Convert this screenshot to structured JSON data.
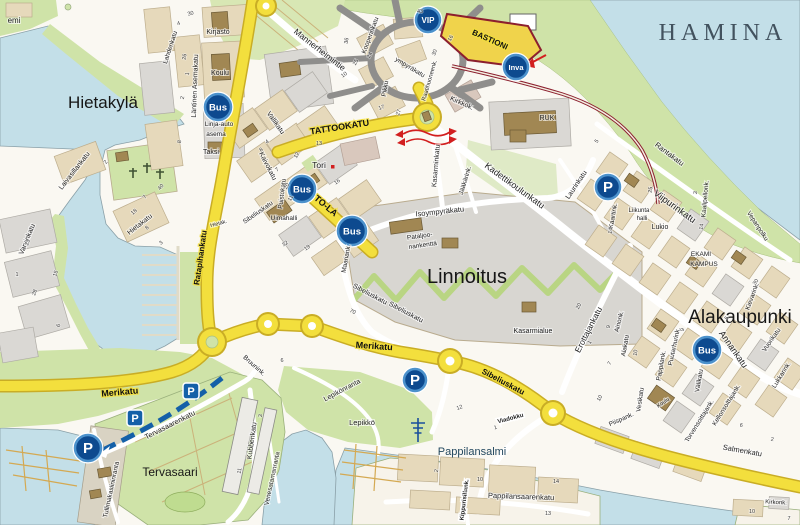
{
  "map_title": "HAMINA",
  "colors": {
    "water": "#c3dfe8",
    "green": "#cfe3a8",
    "yellow_road": "#f3df3d",
    "yellow_edge": "#c9ad25",
    "block_beige": "#e6d9bb",
    "block_gray": "#dad8d4",
    "building_brown": "#a18753",
    "markerBlue": "#0d4a8f",
    "markerRing": "#4c92cc",
    "parkingBlue": "#1460a8",
    "red": "#d21f1f",
    "dark_red": "#8c1f2e"
  },
  "icons": [
    {
      "type": "bus",
      "label": "Bus",
      "x": 218,
      "y": 107,
      "r": 13
    },
    {
      "type": "bus",
      "label": "Bus",
      "x": 302,
      "y": 189,
      "r": 13
    },
    {
      "type": "bus",
      "label": "Bus",
      "x": 352,
      "y": 231,
      "r": 14
    },
    {
      "type": "bus",
      "label": "Bus",
      "x": 707,
      "y": 350,
      "r": 13
    },
    {
      "type": "vip",
      "label": "VIP",
      "x": 428,
      "y": 20,
      "r": 12
    },
    {
      "type": "inva",
      "label": "Inva",
      "x": 516,
      "y": 67,
      "r": 12
    },
    {
      "type": "p-circle",
      "label": "P",
      "x": 608,
      "y": 187,
      "r": 12
    },
    {
      "type": "p-circle",
      "label": "P",
      "x": 415,
      "y": 380,
      "r": 11
    },
    {
      "type": "p-circle",
      "label": "P",
      "x": 88,
      "y": 448,
      "r": 13
    },
    {
      "type": "p-square",
      "label": "P",
      "x": 191,
      "y": 391
    },
    {
      "type": "p-square",
      "label": "P",
      "x": 135,
      "y": 418
    }
  ],
  "labels": [
    {
      "t": "HAMINA",
      "x": 723,
      "y": 40,
      "r": 0,
      "s": 24,
      "k": "title"
    },
    {
      "t": "Hietakylä",
      "x": 103,
      "y": 108,
      "r": 0,
      "s": 17,
      "k": "district"
    },
    {
      "t": "Linnoitus",
      "x": 467,
      "y": 283,
      "r": 0,
      "s": 20,
      "k": "district"
    },
    {
      "t": "Alakaupunki",
      "x": 740,
      "y": 323,
      "r": 0,
      "s": 19,
      "k": "district"
    },
    {
      "t": "Tervasaari",
      "x": 170,
      "y": 476,
      "r": 0,
      "s": 12,
      "k": "district"
    },
    {
      "t": "Pappilansalmi",
      "x": 472,
      "y": 455,
      "r": 0,
      "s": 11,
      "k": "water"
    },
    {
      "t": "emi",
      "x": 14,
      "y": 23,
      "r": 0,
      "s": 8,
      "k": "place"
    },
    {
      "t": "TATTOOKATU",
      "x": 340,
      "y": 130,
      "r": -9,
      "s": 9,
      "k": "ystreet"
    },
    {
      "t": "TO-LA",
      "x": 324,
      "y": 208,
      "r": 40,
      "s": 9,
      "k": "ystreet"
    },
    {
      "t": "BASTIONI",
      "x": 489,
      "y": 42,
      "r": 24,
      "s": 8,
      "k": "ystreet"
    },
    {
      "t": "Merikatu",
      "x": 120,
      "y": 395,
      "r": -5,
      "s": 9,
      "k": "ystreet"
    },
    {
      "t": "Merikatu",
      "x": 374,
      "y": 349,
      "r": 4,
      "s": 9,
      "k": "ystreet"
    },
    {
      "t": "Sibeliuskatu",
      "x": 502,
      "y": 384,
      "r": 28,
      "s": 8,
      "k": "ystreet"
    },
    {
      "t": "Ratapihankatu",
      "x": 203,
      "y": 258,
      "r": -82,
      "s": 8,
      "k": "ystreet"
    },
    {
      "t": "Mannerheimintie",
      "x": 318,
      "y": 52,
      "r": 38,
      "s": 8.5,
      "k": "street"
    },
    {
      "t": "Kadettikoulunkatu",
      "x": 513,
      "y": 188,
      "r": 36,
      "s": 9,
      "k": "street"
    },
    {
      "t": "Viipurinkatu",
      "x": 673,
      "y": 209,
      "r": 36,
      "s": 9.5,
      "k": "street"
    },
    {
      "t": "Rantakatu",
      "x": 668,
      "y": 156,
      "r": 37,
      "s": 7.5,
      "k": "street"
    },
    {
      "t": "Laurinkatu",
      "x": 578,
      "y": 186,
      "r": -56,
      "s": 7,
      "k": "street"
    },
    {
      "t": "Kirkkok.",
      "x": 461,
      "y": 105,
      "r": 24,
      "s": 7,
      "k": "street"
    },
    {
      "t": "Kasarminkatu",
      "x": 438,
      "y": 166,
      "r": -85,
      "s": 7,
      "k": "street"
    },
    {
      "t": "Jääkärink.",
      "x": 467,
      "y": 181,
      "r": -73,
      "s": 6.5,
      "k": "street"
    },
    {
      "t": "Isoympyräkatu",
      "x": 440,
      "y": 214,
      "r": -6,
      "s": 7.5,
      "k": "street"
    },
    {
      "t": "Kaivokatu",
      "x": 266,
      "y": 167,
      "r": 63,
      "s": 7,
      "k": "street"
    },
    {
      "t": "Vallikatu",
      "x": 274,
      "y": 124,
      "r": 55,
      "s": 7,
      "k": "street"
    },
    {
      "t": "Puistokatu",
      "x": 284,
      "y": 194,
      "r": -83,
      "s": 6.5,
      "k": "street"
    },
    {
      "t": "Läntinen Asemakatu",
      "x": 197,
      "y": 86,
      "r": -88,
      "s": 7,
      "k": "street"
    },
    {
      "t": "Lahdenkatu",
      "x": 172,
      "y": 48,
      "r": -72,
      "s": 6.5,
      "k": "street"
    },
    {
      "t": "Laivasillankatu",
      "x": 76,
      "y": 172,
      "r": -52,
      "s": 7,
      "k": "street"
    },
    {
      "t": "Hietakatu",
      "x": 141,
      "y": 226,
      "r": -38,
      "s": 7,
      "k": "street"
    },
    {
      "t": "Hietak.",
      "x": 219,
      "y": 225,
      "r": -15,
      "s": 5.5,
      "k": "street"
    },
    {
      "t": "Varvinkatu",
      "x": 29,
      "y": 240,
      "r": -68,
      "s": 7,
      "k": "street"
    },
    {
      "t": "Sibeliuskatu",
      "x": 259,
      "y": 214,
      "r": -35,
      "s": 6.5,
      "k": "street"
    },
    {
      "t": "Sibeliuskatu",
      "x": 369,
      "y": 296,
      "r": 28,
      "s": 7,
      "k": "street"
    },
    {
      "t": "Sibeliuskatu",
      "x": 405,
      "y": 314,
      "r": 28,
      "s": 7,
      "k": "street"
    },
    {
      "t": "Maariank.",
      "x": 348,
      "y": 259,
      "r": -80,
      "s": 6.5,
      "k": "street"
    },
    {
      "t": "Erottajankatu",
      "x": 591,
      "y": 331,
      "r": -63,
      "s": 8.5,
      "k": "street"
    },
    {
      "t": "Ainonk.",
      "x": 621,
      "y": 322,
      "r": -76,
      "s": 6.5,
      "k": "street"
    },
    {
      "t": "Alakatu",
      "x": 627,
      "y": 346,
      "r": -80,
      "s": 6.5,
      "k": "street"
    },
    {
      "t": "Annankatu",
      "x": 731,
      "y": 351,
      "r": 55,
      "s": 9,
      "k": "street"
    },
    {
      "t": "Puutarhurink.",
      "x": 676,
      "y": 347,
      "r": -78,
      "s": 6.5,
      "k": "street"
    },
    {
      "t": "Pappilank.",
      "x": 663,
      "y": 366,
      "r": -80,
      "s": 6.5,
      "k": "street"
    },
    {
      "t": "Vesikatu",
      "x": 642,
      "y": 400,
      "r": -82,
      "s": 6.5,
      "k": "street"
    },
    {
      "t": "Piispank.",
      "x": 622,
      "y": 421,
      "r": -24,
      "s": 6.5,
      "k": "street"
    },
    {
      "t": "Välikatu",
      "x": 701,
      "y": 381,
      "r": -80,
      "s": 6.5,
      "k": "street"
    },
    {
      "t": "Torvensoittajank.",
      "x": 701,
      "y": 422,
      "r": -58,
      "s": 6.5,
      "k": "street"
    },
    {
      "t": "Kellonsoittajank.",
      "x": 728,
      "y": 406,
      "r": -58,
      "s": 6.5,
      "k": "street"
    },
    {
      "t": "Salmenkatu",
      "x": 742,
      "y": 453,
      "r": 10,
      "s": 7.5,
      "k": "street"
    },
    {
      "t": "Vuorikatu",
      "x": 773,
      "y": 341,
      "r": -55,
      "s": 6.5,
      "k": "street"
    },
    {
      "t": "Lukkarink.",
      "x": 783,
      "y": 376,
      "r": -58,
      "s": 6.5,
      "k": "street"
    },
    {
      "t": "Kievarink.",
      "x": 754,
      "y": 297,
      "r": -70,
      "s": 6.5,
      "k": "street"
    },
    {
      "t": "Kaartink.",
      "x": 615,
      "y": 216,
      "r": -80,
      "s": 6.5,
      "k": "street"
    },
    {
      "t": "Kaalipellonk.",
      "x": 707,
      "y": 199,
      "r": -85,
      "s": 6.5,
      "k": "street"
    },
    {
      "t": "Vepanpolku",
      "x": 756,
      "y": 227,
      "r": 57,
      "s": 6.5,
      "k": "street"
    },
    {
      "t": "Kirkonk.",
      "x": 776,
      "y": 504,
      "r": 3,
      "s": 6,
      "k": "street"
    },
    {
      "t": "Tervasaarenkatu",
      "x": 171,
      "y": 427,
      "r": -27,
      "s": 7.5,
      "k": "street"
    },
    {
      "t": "Tullimakasiininranta",
      "x": 113,
      "y": 490,
      "r": -78,
      "s": 6.5,
      "k": "street"
    },
    {
      "t": "Kubbenkatu",
      "x": 254,
      "y": 441,
      "r": -82,
      "s": 7,
      "k": "street"
    },
    {
      "t": "Venesatamanranta",
      "x": 274,
      "y": 479,
      "r": -78,
      "s": 6.5,
      "k": "street"
    },
    {
      "t": "Lepikönranta",
      "x": 343,
      "y": 392,
      "r": -28,
      "s": 7,
      "k": "street"
    },
    {
      "t": "Bruunink.",
      "x": 253,
      "y": 367,
      "r": 42,
      "s": 6.5,
      "k": "street"
    },
    {
      "t": "Pappilansaarenkatu",
      "x": 521,
      "y": 499,
      "r": 2,
      "s": 7.5,
      "k": "street"
    },
    {
      "t": "Kippurisillank.",
      "x": 466,
      "y": 500,
      "r": -83,
      "s": 6,
      "k": "box"
    },
    {
      "t": "Viadokku",
      "x": 511,
      "y": 420,
      "r": -15,
      "s": 6,
      "k": "box"
    },
    {
      "t": "Pikku",
      "x": 387,
      "y": 89,
      "r": -80,
      "s": 6.5,
      "k": "street"
    },
    {
      "t": "ympyräkatu",
      "x": 409,
      "y": 69,
      "r": 31,
      "s": 6.5,
      "k": "street"
    },
    {
      "t": "Kooperinkatu",
      "x": 372,
      "y": 36,
      "r": -70,
      "s": 6.5,
      "k": "street"
    },
    {
      "t": "Raatihuoneenk.",
      "x": 431,
      "y": 81,
      "r": -74,
      "s": 6,
      "k": "street"
    },
    {
      "t": "Kirjasto",
      "x": 218,
      "y": 34,
      "r": 0,
      "s": 7,
      "k": "place"
    },
    {
      "t": "Koulu",
      "x": 220,
      "y": 75,
      "r": 0,
      "s": 7,
      "k": "place"
    },
    {
      "t": "Linja-auto",
      "x": 219,
      "y": 126,
      "r": 0,
      "s": 6.5,
      "k": "place"
    },
    {
      "t": "asema",
      "x": 216,
      "y": 136,
      "r": 0,
      "s": 6.5,
      "k": "place"
    },
    {
      "t": "Taksi",
      "x": 211,
      "y": 154,
      "r": 0,
      "s": 7,
      "k": "place"
    },
    {
      "t": "Tori",
      "x": 319,
      "y": 168,
      "r": 0,
      "s": 8.5,
      "k": "place"
    },
    {
      "t": "Uimahalli",
      "x": 284,
      "y": 220,
      "r": 0,
      "s": 6.5,
      "k": "place"
    },
    {
      "t": "RUK",
      "x": 547,
      "y": 120,
      "r": 0,
      "s": 7,
      "k": "place"
    },
    {
      "t": "Kasarmialue",
      "x": 533,
      "y": 333,
      "r": 0,
      "s": 7,
      "k": "place"
    },
    {
      "t": "Pataljoo-",
      "x": 420,
      "y": 238,
      "r": -8,
      "s": 6.5,
      "k": "place"
    },
    {
      "t": "nankenttä",
      "x": 423,
      "y": 247,
      "r": -8,
      "s": 6.5,
      "k": "place"
    },
    {
      "t": "Lukio",
      "x": 660,
      "y": 229,
      "r": 0,
      "s": 7,
      "k": "place"
    },
    {
      "t": "Liikunta",
      "x": 639,
      "y": 212,
      "r": 0,
      "s": 6,
      "k": "place"
    },
    {
      "t": "halli",
      "x": 642,
      "y": 220,
      "r": 0,
      "s": 6,
      "k": "place"
    },
    {
      "t": "EKAMI",
      "x": 701,
      "y": 256,
      "r": 0,
      "s": 6.5,
      "k": "place"
    },
    {
      "t": "KAMPUS",
      "x": 704,
      "y": 266,
      "r": 0,
      "s": 6.5,
      "k": "place"
    },
    {
      "t": "Koulu",
      "x": 664,
      "y": 404,
      "r": -35,
      "s": 5.5,
      "k": "place"
    },
    {
      "t": "Lepikkö",
      "x": 362,
      "y": 425,
      "r": 0,
      "s": 7.5,
      "k": "place"
    },
    {
      "t": "30",
      "x": 191,
      "y": 15,
      "r": -15,
      "s": 5.5,
      "k": "num"
    },
    {
      "t": "4",
      "x": 179,
      "y": 25,
      "r": -15,
      "s": 5.5,
      "k": "num"
    },
    {
      "t": "26",
      "x": 186,
      "y": 57,
      "r": -80,
      "s": 5.5,
      "k": "num"
    },
    {
      "t": "1",
      "x": 189,
      "y": 74,
      "r": -80,
      "s": 5.5,
      "k": "num"
    },
    {
      "t": "2",
      "x": 184,
      "y": 98,
      "r": -80,
      "s": 5.5,
      "k": "num"
    },
    {
      "t": "8",
      "x": 181,
      "y": 142,
      "r": -80,
      "s": 5.5,
      "k": "num"
    },
    {
      "t": "23",
      "x": 29,
      "y": 243,
      "r": -70,
      "s": 5.5,
      "k": "num"
    },
    {
      "t": "15",
      "x": 57,
      "y": 274,
      "r": -70,
      "s": 5.5,
      "k": "num"
    },
    {
      "t": "28",
      "x": 36,
      "y": 293,
      "r": -70,
      "s": 5.5,
      "k": "num"
    },
    {
      "t": "6",
      "x": 60,
      "y": 326,
      "r": -70,
      "s": 5.5,
      "k": "num"
    },
    {
      "t": "1",
      "x": 17,
      "y": 276,
      "r": 0,
      "s": 5.5,
      "k": "num"
    },
    {
      "t": "40",
      "x": 162,
      "y": 188,
      "r": -50,
      "s": 5.5,
      "k": "num"
    },
    {
      "t": "7",
      "x": 146,
      "y": 198,
      "r": -50,
      "s": 5.5,
      "k": "num"
    },
    {
      "t": "18",
      "x": 135,
      "y": 213,
      "r": -40,
      "s": 5.5,
      "k": "num"
    },
    {
      "t": "8",
      "x": 148,
      "y": 229,
      "r": -40,
      "s": 5.5,
      "k": "num"
    },
    {
      "t": "3",
      "x": 162,
      "y": 244,
      "r": -40,
      "s": 5.5,
      "k": "num"
    },
    {
      "t": "2",
      "x": 107,
      "y": 163,
      "r": -55,
      "s": 5.5,
      "k": "num"
    },
    {
      "t": "4",
      "x": 268,
      "y": 143,
      "r": -35,
      "s": 5.5,
      "k": "num"
    },
    {
      "t": "8",
      "x": 262,
      "y": 151,
      "r": -35,
      "s": 5.5,
      "k": "num"
    },
    {
      "t": "7",
      "x": 278,
      "y": 171,
      "r": -35,
      "s": 5.5,
      "k": "num"
    },
    {
      "t": "12",
      "x": 298,
      "y": 156,
      "r": -60,
      "s": 5.5,
      "k": "num"
    },
    {
      "t": "13",
      "x": 319,
      "y": 145,
      "r": 0,
      "s": 5.5,
      "k": "num"
    },
    {
      "t": "16",
      "x": 338,
      "y": 183,
      "r": -35,
      "s": 5.5,
      "k": "num"
    },
    {
      "t": "20",
      "x": 288,
      "y": 187,
      "r": -60,
      "s": 5.5,
      "k": "num"
    },
    {
      "t": "11",
      "x": 292,
      "y": 199,
      "r": -60,
      "s": 5.5,
      "k": "num"
    },
    {
      "t": "19",
      "x": 308,
      "y": 249,
      "r": -35,
      "s": 5.5,
      "k": "num"
    },
    {
      "t": "32",
      "x": 286,
      "y": 245,
      "r": -35,
      "s": 5.5,
      "k": "num"
    },
    {
      "t": "24",
      "x": 371,
      "y": 56,
      "r": -60,
      "s": 5.5,
      "k": "num"
    },
    {
      "t": "25",
      "x": 357,
      "y": 63,
      "r": -60,
      "s": 5.5,
      "k": "num"
    },
    {
      "t": "36",
      "x": 348,
      "y": 41,
      "r": -80,
      "s": 5.5,
      "k": "num"
    },
    {
      "t": "17",
      "x": 382,
      "y": 109,
      "r": -20,
      "s": 5.5,
      "k": "num"
    },
    {
      "t": "27",
      "x": 400,
      "y": 113,
      "r": -70,
      "s": 5.5,
      "k": "num"
    },
    {
      "t": "30",
      "x": 436,
      "y": 53,
      "r": -70,
      "s": 5.5,
      "k": "num"
    },
    {
      "t": "16",
      "x": 452,
      "y": 39,
      "r": -60,
      "s": 5.5,
      "k": "num"
    },
    {
      "t": "43",
      "x": 420,
      "y": 13,
      "r": 0,
      "s": 5.5,
      "k": "num"
    },
    {
      "t": "10",
      "x": 345,
      "y": 76,
      "r": -35,
      "s": 5.5,
      "k": "num"
    },
    {
      "t": "5",
      "x": 598,
      "y": 142,
      "r": -55,
      "s": 5.5,
      "k": "num"
    },
    {
      "t": "25",
      "x": 652,
      "y": 190,
      "r": -80,
      "s": 5.5,
      "k": "num"
    },
    {
      "t": "3",
      "x": 697,
      "y": 193,
      "r": -80,
      "s": 5.5,
      "k": "num"
    },
    {
      "t": "14",
      "x": 703,
      "y": 227,
      "r": -80,
      "s": 5.5,
      "k": "num"
    },
    {
      "t": "30",
      "x": 757,
      "y": 283,
      "r": -55,
      "s": 5.5,
      "k": "num"
    },
    {
      "t": "20",
      "x": 580,
      "y": 307,
      "r": -60,
      "s": 5.5,
      "k": "num"
    },
    {
      "t": "1",
      "x": 591,
      "y": 343,
      "r": -60,
      "s": 5.5,
      "k": "num"
    },
    {
      "t": "7",
      "x": 611,
      "y": 364,
      "r": -60,
      "s": 5.5,
      "k": "num"
    },
    {
      "t": "10",
      "x": 601,
      "y": 399,
      "r": -60,
      "s": 5.5,
      "k": "num"
    },
    {
      "t": "9",
      "x": 610,
      "y": 327,
      "r": -80,
      "s": 5.5,
      "k": "num"
    },
    {
      "t": "10",
      "x": 637,
      "y": 353,
      "r": -80,
      "s": 5.5,
      "k": "num"
    },
    {
      "t": "9",
      "x": 684,
      "y": 330,
      "r": -80,
      "s": 5.5,
      "k": "num"
    },
    {
      "t": "5",
      "x": 728,
      "y": 319,
      "r": -55,
      "s": 5.5,
      "k": "num"
    },
    {
      "t": "6",
      "x": 741,
      "y": 427,
      "r": 8,
      "s": 5.5,
      "k": "num"
    },
    {
      "t": "2",
      "x": 772,
      "y": 441,
      "r": 8,
      "s": 5.5,
      "k": "num"
    },
    {
      "t": "70",
      "x": 352,
      "y": 313,
      "r": 25,
      "s": 5.5,
      "k": "num"
    },
    {
      "t": "14",
      "x": 612,
      "y": 231,
      "r": -80,
      "s": 5.5,
      "k": "num"
    },
    {
      "t": "12",
      "x": 460,
      "y": 409,
      "r": -18,
      "s": 5.5,
      "k": "num"
    },
    {
      "t": "1",
      "x": 496,
      "y": 429,
      "r": -18,
      "s": 5.5,
      "k": "num"
    },
    {
      "t": "10",
      "x": 480,
      "y": 481,
      "r": 0,
      "s": 5.5,
      "k": "num"
    },
    {
      "t": "14",
      "x": 556,
      "y": 483,
      "r": 0,
      "s": 5.5,
      "k": "num"
    },
    {
      "t": "13",
      "x": 548,
      "y": 515,
      "r": 0,
      "s": 5.5,
      "k": "num"
    },
    {
      "t": "1",
      "x": 466,
      "y": 492,
      "r": 0,
      "s": 5.5,
      "k": "num"
    },
    {
      "t": "2",
      "x": 438,
      "y": 471,
      "r": -80,
      "s": 5.5,
      "k": "num"
    },
    {
      "t": "10",
      "x": 752,
      "y": 513,
      "r": 0,
      "s": 5.5,
      "k": "num"
    },
    {
      "t": "7",
      "x": 789,
      "y": 520,
      "r": 0,
      "s": 5.5,
      "k": "num"
    },
    {
      "t": "11",
      "x": 241,
      "y": 471,
      "r": -80,
      "s": 5.5,
      "k": "num"
    },
    {
      "t": "3",
      "x": 262,
      "y": 416,
      "r": -80,
      "s": 5.5,
      "k": "num"
    },
    {
      "t": "6",
      "x": 282,
      "y": 362,
      "r": 0,
      "s": 5.5,
      "k": "num"
    }
  ]
}
